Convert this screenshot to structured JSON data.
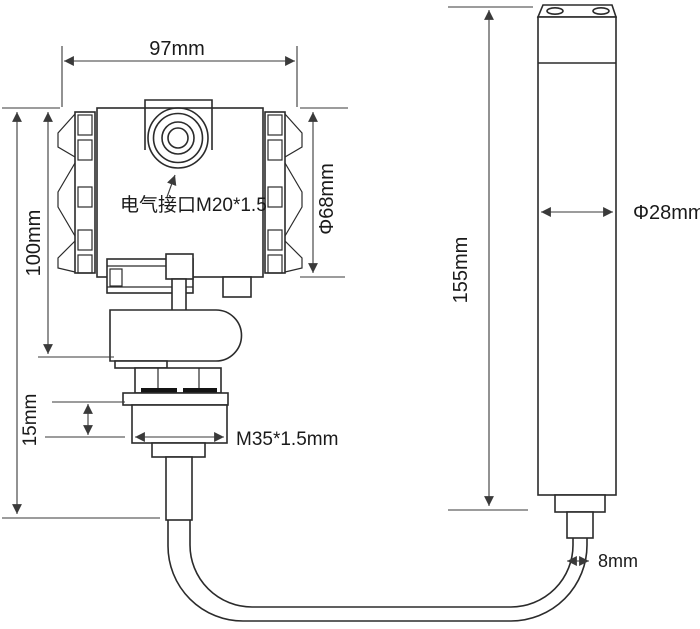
{
  "labels": {
    "top_width": "97mm",
    "left_height": "100mm",
    "head_diameter": "Φ68mm",
    "electrical_port": "电气接口M20*1.5",
    "thread_height": "15mm",
    "thread_spec": "M35*1.5mm",
    "probe_length": "155mm",
    "probe_diameter": "Φ28mm",
    "cable_diameter": "8mm"
  },
  "dimensions_mm": {
    "head_width": 97,
    "head_height": 100,
    "head_diameter": 68,
    "electrical_interface_thread": "M20*1.5",
    "process_thread": "M35*1.5",
    "thread_length": 15,
    "probe_length": 155,
    "probe_diameter": 28,
    "cable_diameter": 8
  },
  "colors": {
    "background": "#ffffff",
    "part_line": "#2b2b2b",
    "dimension_line": "#3a3a3a",
    "text": "#1a1a1a",
    "seal_fill": "#141414"
  }
}
